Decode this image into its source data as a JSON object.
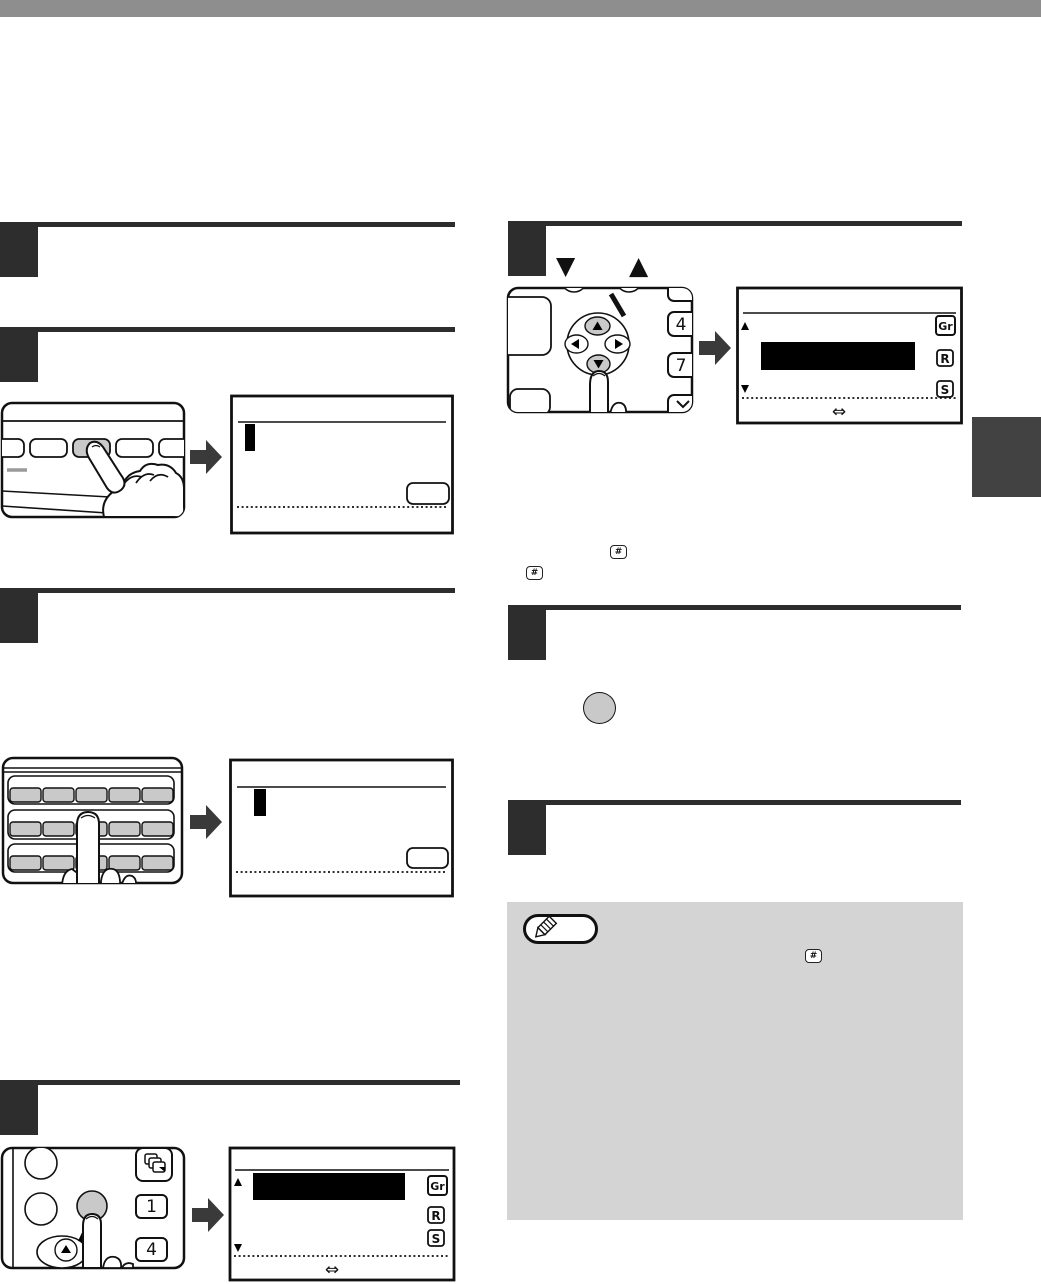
{
  "page": {
    "background": "#ffffff",
    "top_bar_color": "#8e8e8e",
    "step_marker_color": "#2d2d2d",
    "side_tab_color": "#424242",
    "arrow_color": "#3a3a3a",
    "key_fill_gray": "#c9c9c9",
    "note_box_fill": "#d4d4d4",
    "lcd_highlight_color": "#000000",
    "outline_color": "#111111"
  },
  "glyphs": {
    "down_triangle": "▼",
    "up_triangle": "▲",
    "swap_arrow": "⇔",
    "hash_key": "#"
  },
  "keys": {
    "one": "1",
    "four": "4",
    "seven": "7"
  },
  "lcd_mode_icons": {
    "group": "Gr",
    "resolution": "R",
    "standard": "S"
  }
}
